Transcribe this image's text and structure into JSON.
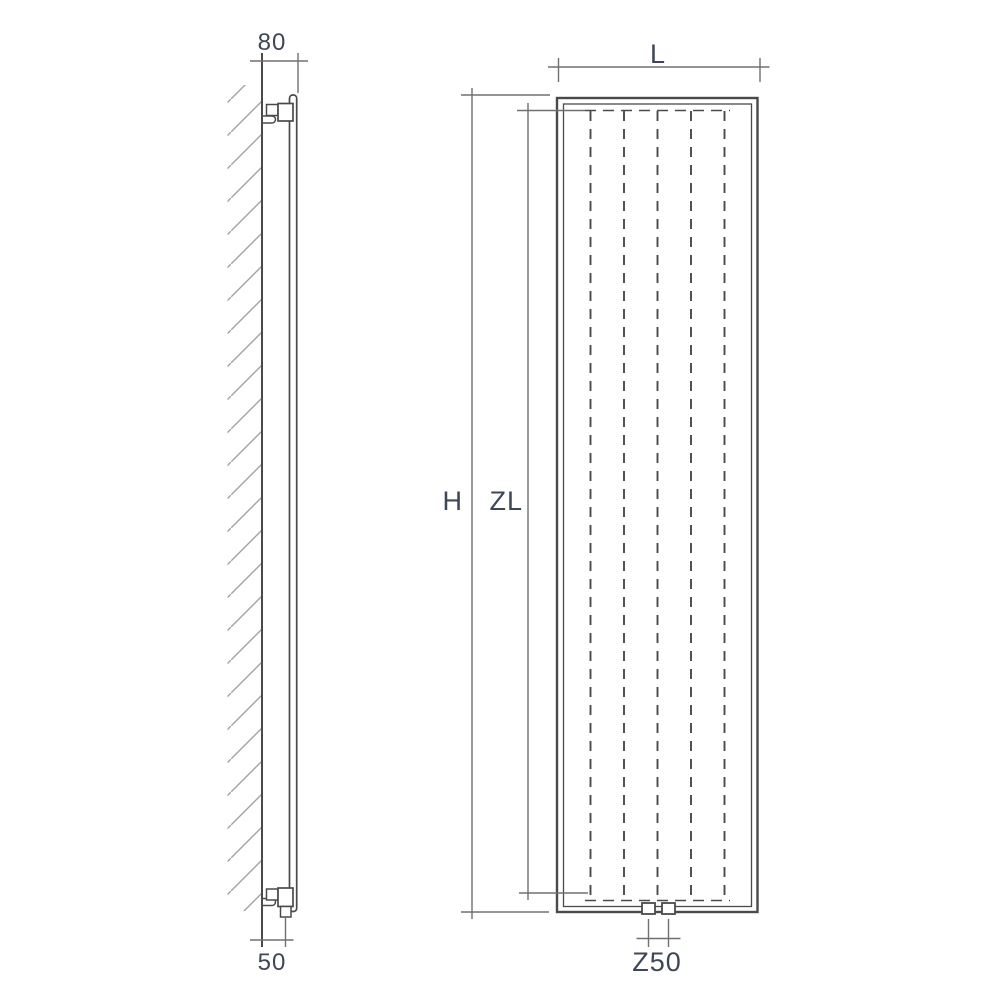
{
  "drawing": {
    "kind": "radiator-technical-drawing",
    "description": "Vertical panel radiator: wall-mounted side profile (left) and front elevation (right) with dimension lines",
    "colors": {
      "background": "#ffffff",
      "main_line": "#4a4a4a",
      "dimension_line": "#707070",
      "hatch_line": "#a3a3a3",
      "label_text": "#3d4757"
    },
    "side_view": {
      "dim_wall_offset": {
        "label": "80"
      },
      "dim_pipe_offset": {
        "label": "50"
      }
    },
    "front_view": {
      "convector_channel_count": 5,
      "dim_width": {
        "label": "L"
      },
      "dim_height": {
        "label": "H"
      },
      "dim_convector_height": {
        "label": "ZL"
      },
      "dim_pipe_centres": {
        "label": "Z50"
      }
    }
  }
}
